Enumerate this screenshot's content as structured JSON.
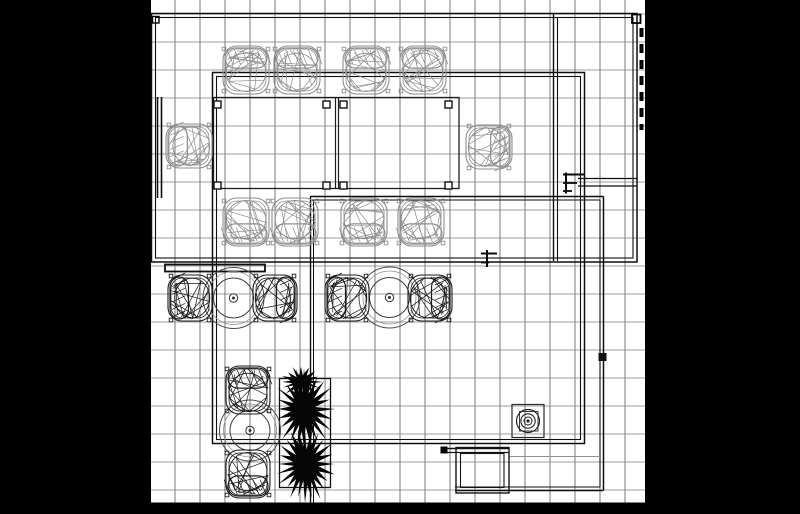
{
  "meta": {
    "description": "black and white CAD architectural floor plan, top view furniture layout"
  },
  "canvas": {
    "width": 800,
    "height": 514,
    "bg": "#000000"
  },
  "paper": {
    "x": 151,
    "y": 0,
    "w": 494,
    "h": 503,
    "fill": "#ffffff"
  },
  "covers": [
    {
      "x": 0,
      "y": 0,
      "w": 151,
      "h": 514
    },
    {
      "x": 645,
      "y": 0,
      "w": 155,
      "h": 514
    },
    {
      "x": 0,
      "y": 502.5,
      "w": 800,
      "h": 11.5
    }
  ],
  "grid": {
    "x0": 150,
    "xStep": 25,
    "x1": 646,
    "y0": 14,
    "yStep": 28,
    "y1": 502,
    "xMin": 151,
    "xMax": 645,
    "yMin": 0,
    "yMax": 502.5,
    "vColor": "#585858",
    "hColor": "#7b7b7b",
    "width": 0.8
  },
  "colors": {
    "wall": "#0e0e0e",
    "furniture": "#1c1c1c",
    "gray": "#8e8e8e",
    "black": "#1b1b1b",
    "plant": "#060606"
  },
  "wall_rects": [
    {
      "x": 151.5,
      "y": 13.5,
      "w": 485.5,
      "h": 248.5,
      "c": "#0e0e0e",
      "sw": 1.5
    },
    {
      "x": 155.5,
      "y": 17.5,
      "w": 477.5,
      "h": 240.5,
      "c": "#0e0e0e",
      "sw": 1.1
    },
    {
      "x": 212.5,
      "y": 72.5,
      "w": 372,
      "h": 371,
      "c": "#0e0e0e",
      "sw": 1.5
    },
    {
      "x": 216.5,
      "y": 76.5,
      "w": 364,
      "h": 363,
      "c": "#0e0e0e",
      "sw": 1.1
    }
  ],
  "object_rects": [
    {
      "x": 165,
      "y": 264.5,
      "w": 100,
      "h": 7,
      "c": "#0f0f0f",
      "sw": 1.8
    },
    {
      "x": 512,
      "y": 404.5,
      "w": 32,
      "h": 33,
      "c": "#2a2a2a",
      "sw": 1.2
    },
    {
      "x": 519.5,
      "y": 411.5,
      "w": 18.5,
      "h": 19.5,
      "c": "#3a3a3a",
      "sw": 1
    },
    {
      "x": 456,
      "y": 447.5,
      "w": 53,
      "h": 45.5,
      "c": "#141414",
      "sw": 1.4
    },
    {
      "x": 460.5,
      "y": 453.5,
      "w": 43.5,
      "h": 34,
      "c": "#141414",
      "sw": 1.1
    },
    {
      "x": 279.5,
      "y": 378.5,
      "w": 51,
      "h": 109,
      "c": "#101010",
      "sw": 1.3
    },
    {
      "x": 152.5,
      "y": 16.5,
      "w": 6.5,
      "h": 6.5,
      "c": "#000000",
      "sw": 1.4
    },
    {
      "x": 632,
      "y": 14.5,
      "w": 8.5,
      "h": 8.5,
      "c": "#000000",
      "sw": 1.8
    }
  ],
  "filled_rects": [
    {
      "x": 440.5,
      "y": 446.5,
      "w": 7,
      "h": 7,
      "c": "#050505"
    },
    {
      "x": 598.5,
      "y": 353,
      "w": 8,
      "h": 8,
      "c": "#111111"
    }
  ],
  "wall_lines": [
    {
      "x1": 310,
      "y1": 196.5,
      "x2": 603.5,
      "y2": 196.5,
      "sw": 1.5,
      "c": "#0e0e0e"
    },
    {
      "x1": 603.5,
      "y1": 196.5,
      "x2": 603.5,
      "y2": 490.5,
      "sw": 1.5,
      "c": "#0e0e0e"
    },
    {
      "x1": 603.5,
      "y1": 490.5,
      "x2": 455,
      "y2": 490.5,
      "sw": 1.5,
      "c": "#0e0e0e"
    },
    {
      "x1": 310,
      "y1": 200,
      "x2": 600,
      "y2": 200,
      "sw": 1.1,
      "c": "#0e0e0e"
    },
    {
      "x1": 600,
      "y1": 200,
      "x2": 600,
      "y2": 487,
      "sw": 1.1,
      "c": "#0e0e0e"
    },
    {
      "x1": 600,
      "y1": 487,
      "x2": 455,
      "y2": 487,
      "sw": 1.1,
      "c": "#0e0e0e"
    },
    {
      "x1": 310.5,
      "y1": 196.5,
      "x2": 310.5,
      "y2": 502.5,
      "sw": 1.4,
      "c": "#0e0e0e"
    },
    {
      "x1": 313.5,
      "y1": 200,
      "x2": 313.5,
      "y2": 502.5,
      "sw": 1,
      "c": "#0e0e0e"
    },
    {
      "x1": 578,
      "y1": 178.5,
      "x2": 637,
      "y2": 178.5,
      "sw": 1.3,
      "c": "#0e0e0e"
    },
    {
      "x1": 578,
      "y1": 186,
      "x2": 637,
      "y2": 186,
      "sw": 1.3,
      "c": "#0e0e0e"
    },
    {
      "x1": 553.5,
      "y1": 13.5,
      "x2": 553.5,
      "y2": 261,
      "sw": 1.4,
      "c": "#0e0e0e"
    },
    {
      "x1": 557.5,
      "y1": 17,
      "x2": 557.5,
      "y2": 261,
      "sw": 1.1,
      "c": "#0e0e0e"
    },
    {
      "x1": 157.5,
      "y1": 97,
      "x2": 157.5,
      "y2": 198,
      "sw": 1.6,
      "c": "#0e0e0e"
    },
    {
      "x1": 161.5,
      "y1": 97,
      "x2": 161.5,
      "y2": 198,
      "sw": 1.6,
      "c": "#0e0e0e"
    },
    {
      "x1": 335.5,
      "y1": 97.5,
      "x2": 335.5,
      "y2": 188.5,
      "sw": 1.2,
      "c": "#1c1c1c"
    },
    {
      "x1": 338.5,
      "y1": 97.5,
      "x2": 338.5,
      "y2": 188.5,
      "sw": 1.2,
      "c": "#1c1c1c"
    },
    {
      "x1": 442,
      "y1": 448.5,
      "x2": 508.5,
      "y2": 448.5,
      "sw": 1.4,
      "c": "#141414"
    },
    {
      "x1": 442,
      "y1": 452.5,
      "x2": 508.5,
      "y2": 452.5,
      "sw": 1.2,
      "c": "#141414"
    },
    {
      "x1": 508.5,
      "y1": 456.5,
      "x2": 600,
      "y2": 456.5,
      "sw": 1,
      "c": "#909090"
    },
    {
      "x1": 566,
      "y1": 172.5,
      "x2": 566,
      "y2": 193.5,
      "sw": 2,
      "c": "#0a0a0a"
    },
    {
      "x1": 563,
      "y1": 174.5,
      "x2": 584,
      "y2": 174.5,
      "sw": 2,
      "c": "#0a0a0a"
    },
    {
      "x1": 563,
      "y1": 183,
      "x2": 577,
      "y2": 183,
      "sw": 1.8,
      "c": "#0a0a0a"
    },
    {
      "x1": 563,
      "y1": 191,
      "x2": 572,
      "y2": 191,
      "sw": 1.8,
      "c": "#0a0a0a"
    },
    {
      "x1": 487,
      "y1": 250,
      "x2": 487,
      "y2": 267,
      "sw": 2,
      "c": "#0a0a0a"
    },
    {
      "x1": 481,
      "y1": 253.5,
      "x2": 497,
      "y2": 253.5,
      "sw": 2,
      "c": "#0a0a0a"
    },
    {
      "x1": 481,
      "y1": 262.5,
      "x2": 489,
      "y2": 262.5,
      "sw": 1.8,
      "c": "#0a0a0a"
    }
  ],
  "dashed_lines": [
    {
      "x1": 641.5,
      "y1": 28,
      "x2": 641.5,
      "y2": 130,
      "sw": 4,
      "c": "#000000",
      "dash": "9,7"
    }
  ],
  "conference_table": {
    "x": 213.5,
    "y": 97.5,
    "w": 245.5,
    "h": 91,
    "sw": 1.3,
    "c": "#1c1c1c",
    "leg_size": 7,
    "leg_sw": 1.4,
    "legs": [
      [
        217.5,
        104.5
      ],
      [
        326.5,
        104.5
      ],
      [
        343.5,
        104.5
      ],
      [
        448.5,
        104.5
      ],
      [
        217.5,
        185.5
      ],
      [
        326.5,
        185.5
      ],
      [
        343.5,
        185.5
      ],
      [
        448.5,
        185.5
      ]
    ]
  },
  "round_tables": {
    "positions": [
      [
        233.5,
        298
      ],
      [
        389.5,
        297.5
      ],
      [
        250,
        430.5
      ]
    ],
    "rings": [
      {
        "r": 30.5,
        "sw": 1,
        "c": "#4a4a4a"
      },
      {
        "r": 26.5,
        "sw": 0.8,
        "c": "#8f8f8f"
      },
      {
        "r": 20,
        "sw": 1,
        "c": "#3f3f3f"
      },
      {
        "r": 4.2,
        "sw": 1,
        "c": "#333333"
      }
    ],
    "dot_r": 1.5
  },
  "chairs": [
    {
      "cx": 246,
      "cy": 70,
      "rot": 0,
      "w": 46,
      "h": 48,
      "tone": "gray",
      "seed": 11
    },
    {
      "cx": 297,
      "cy": 70,
      "rot": 0,
      "w": 46,
      "h": 48,
      "tone": "gray",
      "seed": 12
    },
    {
      "cx": 366,
      "cy": 70,
      "rot": 0,
      "w": 46,
      "h": 48,
      "tone": "gray",
      "seed": 13
    },
    {
      "cx": 423,
      "cy": 70,
      "rot": 0,
      "w": 46,
      "h": 48,
      "tone": "gray",
      "seed": 14
    },
    {
      "cx": 189,
      "cy": 146,
      "rot": 270,
      "w": 44,
      "h": 46,
      "tone": "gray",
      "seed": 15
    },
    {
      "cx": 489,
      "cy": 147,
      "rot": 90,
      "w": 44,
      "h": 46,
      "tone": "gray",
      "seed": 16
    },
    {
      "cx": 246,
      "cy": 222,
      "rot": 180,
      "w": 46,
      "h": 48,
      "tone": "gray",
      "seed": 17
    },
    {
      "cx": 295,
      "cy": 222,
      "rot": 180,
      "w": 46,
      "h": 48,
      "tone": "gray",
      "seed": 18
    },
    {
      "cx": 364,
      "cy": 222,
      "rot": 180,
      "w": 46,
      "h": 48,
      "tone": "gray",
      "seed": 19
    },
    {
      "cx": 421,
      "cy": 222,
      "rot": 180,
      "w": 46,
      "h": 48,
      "tone": "gray",
      "seed": 20
    },
    {
      "cx": 190,
      "cy": 298,
      "rot": 270,
      "w": 46,
      "h": 44,
      "tone": "black",
      "seed": 21
    },
    {
      "cx": 275,
      "cy": 298,
      "rot": 90,
      "w": 46,
      "h": 44,
      "tone": "black",
      "seed": 22
    },
    {
      "cx": 347,
      "cy": 298,
      "rot": 270,
      "w": 46,
      "h": 44,
      "tone": "black",
      "seed": 23
    },
    {
      "cx": 430,
      "cy": 298,
      "rot": 90,
      "w": 46,
      "h": 44,
      "tone": "black",
      "seed": 24
    },
    {
      "cx": 248,
      "cy": 390,
      "rot": 0,
      "w": 44,
      "h": 48,
      "tone": "black",
      "seed": 25
    },
    {
      "cx": 248,
      "cy": 474,
      "rot": 180,
      "w": 44,
      "h": 48,
      "tone": "black",
      "seed": 26
    }
  ],
  "fixture_circles": {
    "cx": 528,
    "cy": 421,
    "rings": [
      {
        "r": 11.5,
        "sw": 1.2,
        "c": "#222222"
      },
      {
        "r": 7.2,
        "sw": 1.1,
        "c": "#222222"
      },
      {
        "r": 4,
        "sw": 1,
        "c": "#222222"
      }
    ],
    "dot_r": 1.6
  },
  "plants": [
    {
      "cx": 304,
      "cy": 409,
      "rx": 29,
      "ry": 40,
      "spikes": 24,
      "seed": 41
    },
    {
      "cx": 305,
      "cy": 464,
      "rx": 29,
      "ry": 38,
      "spikes": 24,
      "seed": 42
    },
    {
      "cx": 301,
      "cy": 382,
      "rx": 20,
      "ry": 15,
      "spikes": 16,
      "seed": 43
    }
  ]
}
